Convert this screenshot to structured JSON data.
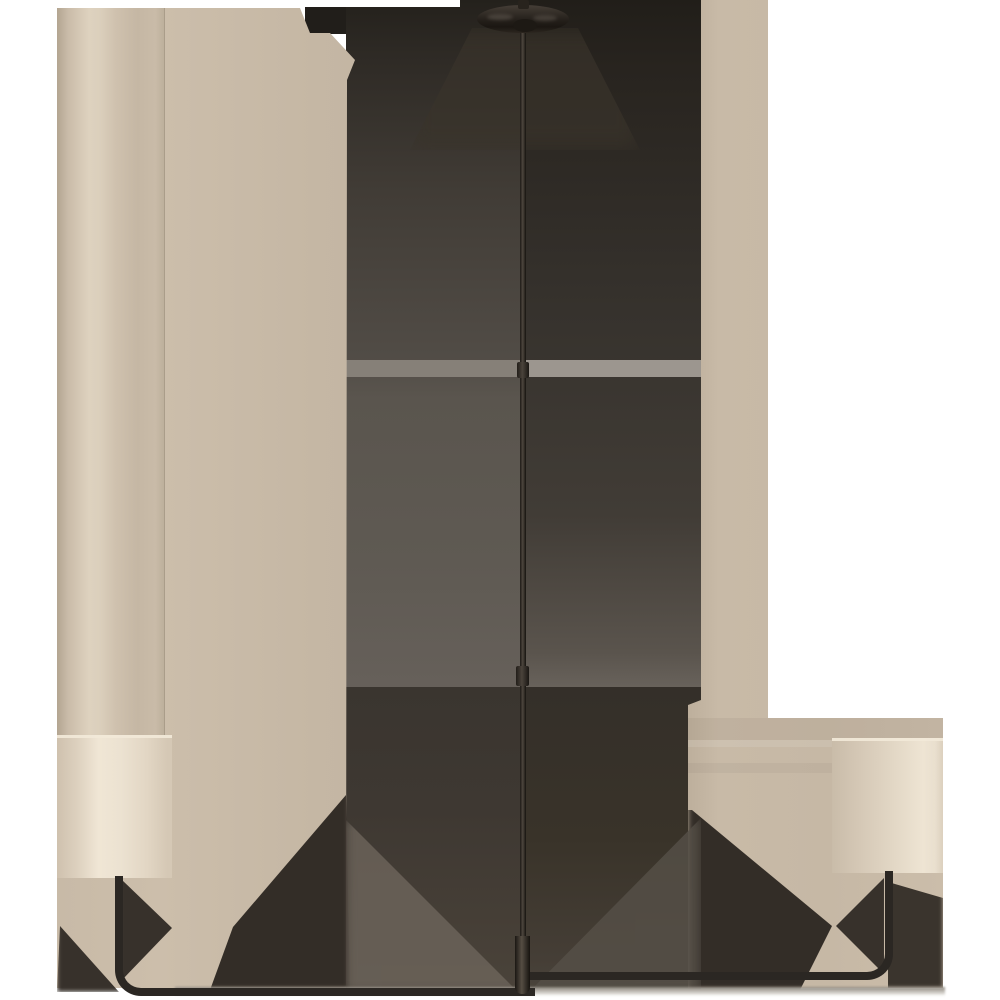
{
  "scene": {
    "type": "product-photograph",
    "subject": "two-light-linear-chandelier",
    "finish": "dark-bronze",
    "shade_style": "cylindrical-cream-shades",
    "background": "white-with-beige-backdrop-panels-and-dark-shadow-field"
  },
  "palette": {
    "white": "#ffffff",
    "beige_base": "#c6b8a5",
    "beige_light": "#cfc2b0",
    "column_hi": "#ded2bf",
    "column_lo": "#b3a591",
    "shade_cream": "#eae0cf",
    "shade_hi": "#f2e9d8",
    "shade_edge": "#cfc1ae",
    "dark_top": "#211e1a",
    "dark_mid_left": "#56514b",
    "dark_mid_left2": "#66605a",
    "dark_mid_right": "#3a3631",
    "dark_low_left": "#39342e",
    "dark_low_right": "#332e28",
    "dark_wedge": "#332d27",
    "gray_stripe_l": "#868078",
    "gray_stripe_r": "#9c968f",
    "lighter_wedge": "#6b635a",
    "lighter_wedge_r": "#554f47",
    "metal": "#2b2723",
    "metal_hi": "#554d43",
    "glow": "#3a342b",
    "fade": "#8b857c"
  }
}
